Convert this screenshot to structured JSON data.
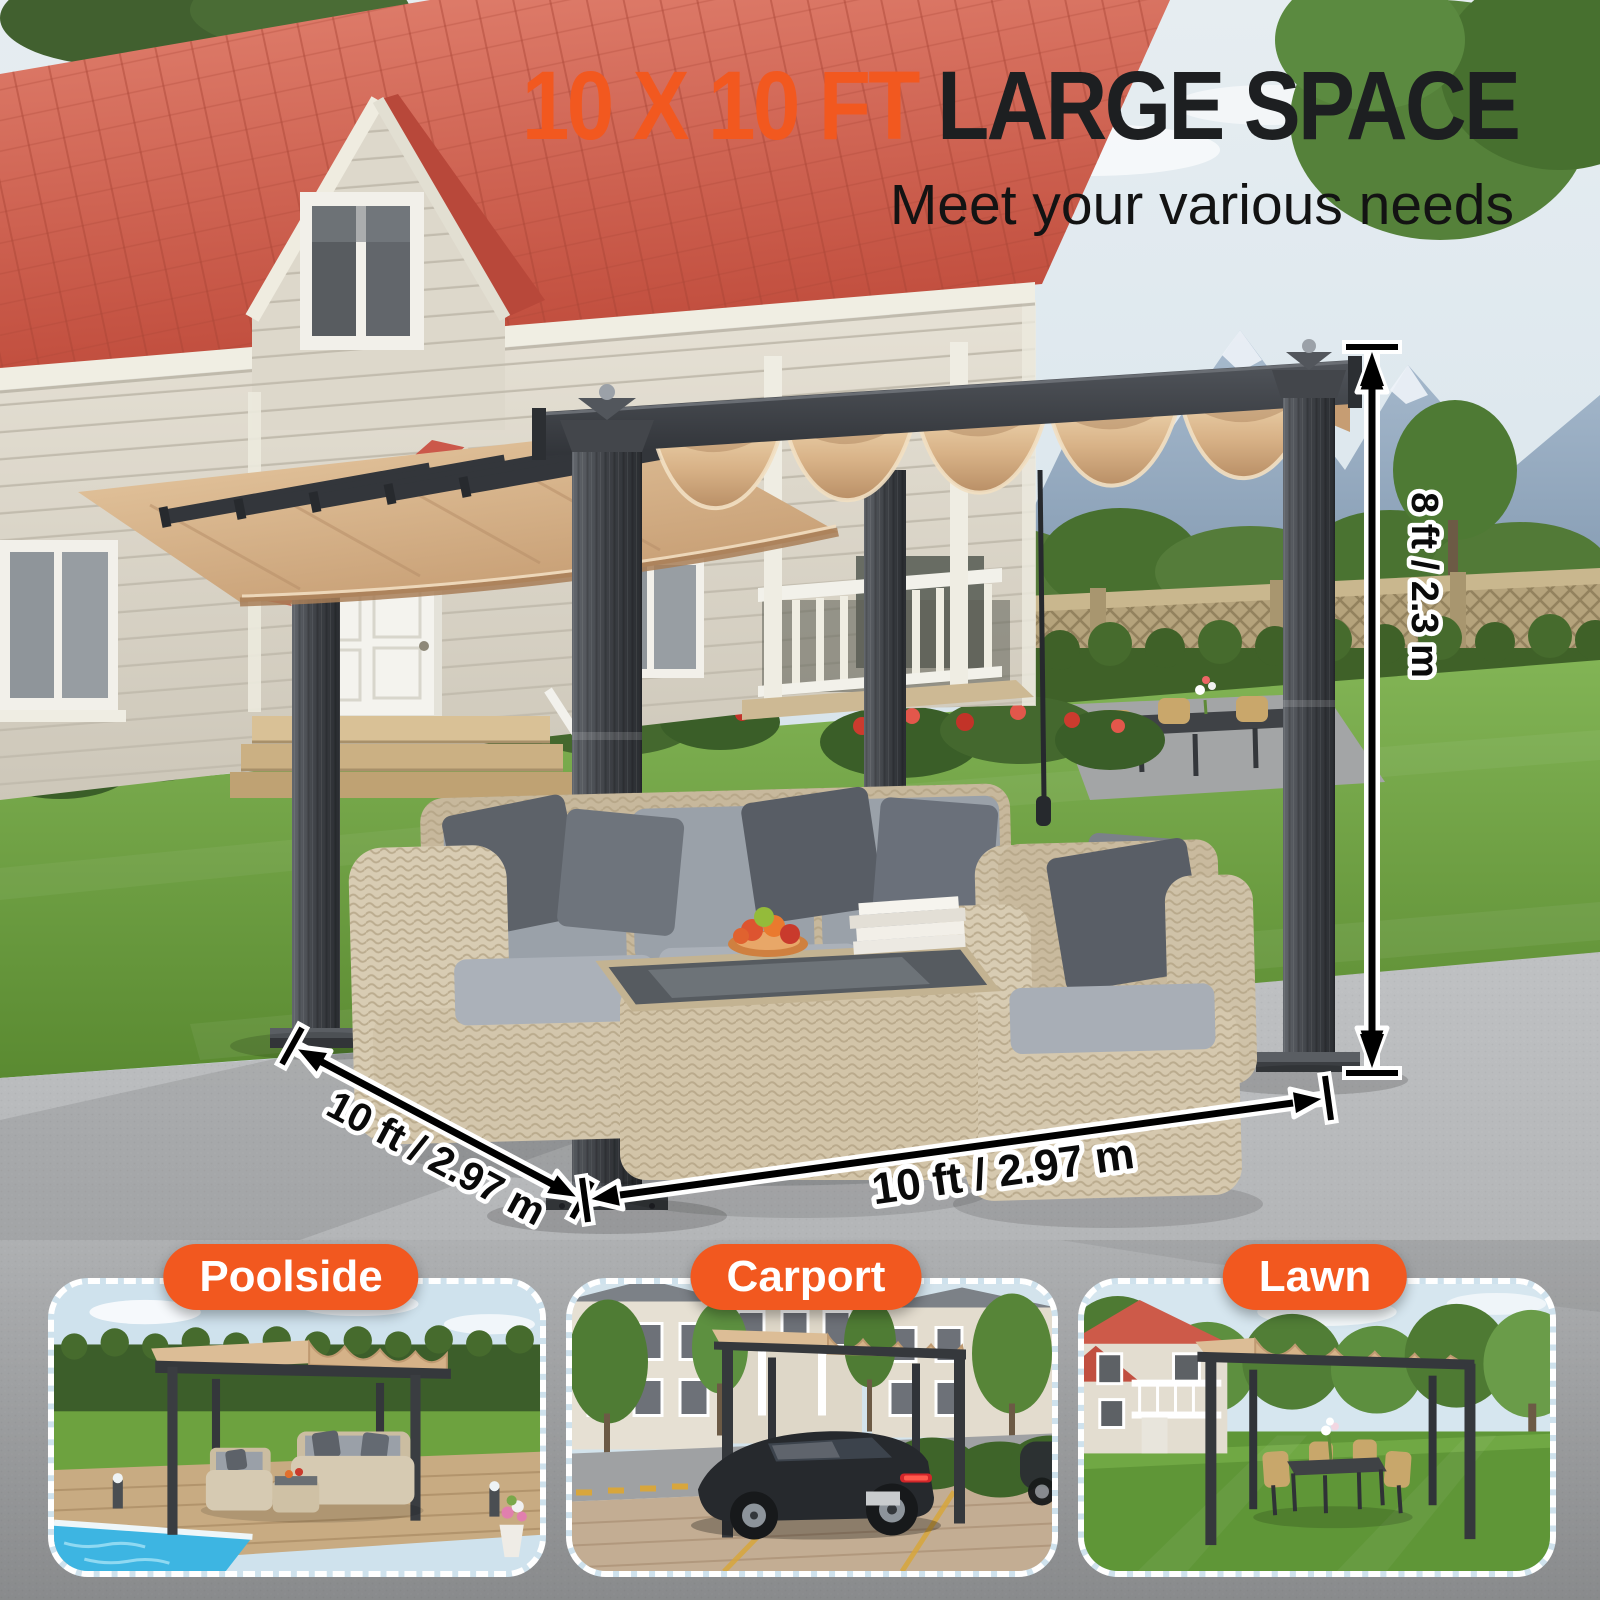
{
  "header": {
    "title_highlight": "10 X 10 FT",
    "title_rest": "LARGE SPACE",
    "subtitle": "Meet your various needs"
  },
  "dimensions": {
    "height": "8 ft / 2.3 m",
    "side_depth": "10 ft / 2.97 m",
    "front_width": "10 ft / 2.97 m"
  },
  "use_cases": [
    {
      "label": "Poolside"
    },
    {
      "label": "Carport"
    },
    {
      "label": "Lawn"
    }
  ],
  "colors": {
    "accent_orange": "#F2581F",
    "title_black": "#1D1F21",
    "canopy_beige": "#DCB88F",
    "frame_gray": "#3A3D41",
    "roof_red": "#CF5D4C",
    "grass_green": "#6FA23E",
    "concrete_gray": "#B5B6B8",
    "pool_blue": "#3DB6E3"
  }
}
